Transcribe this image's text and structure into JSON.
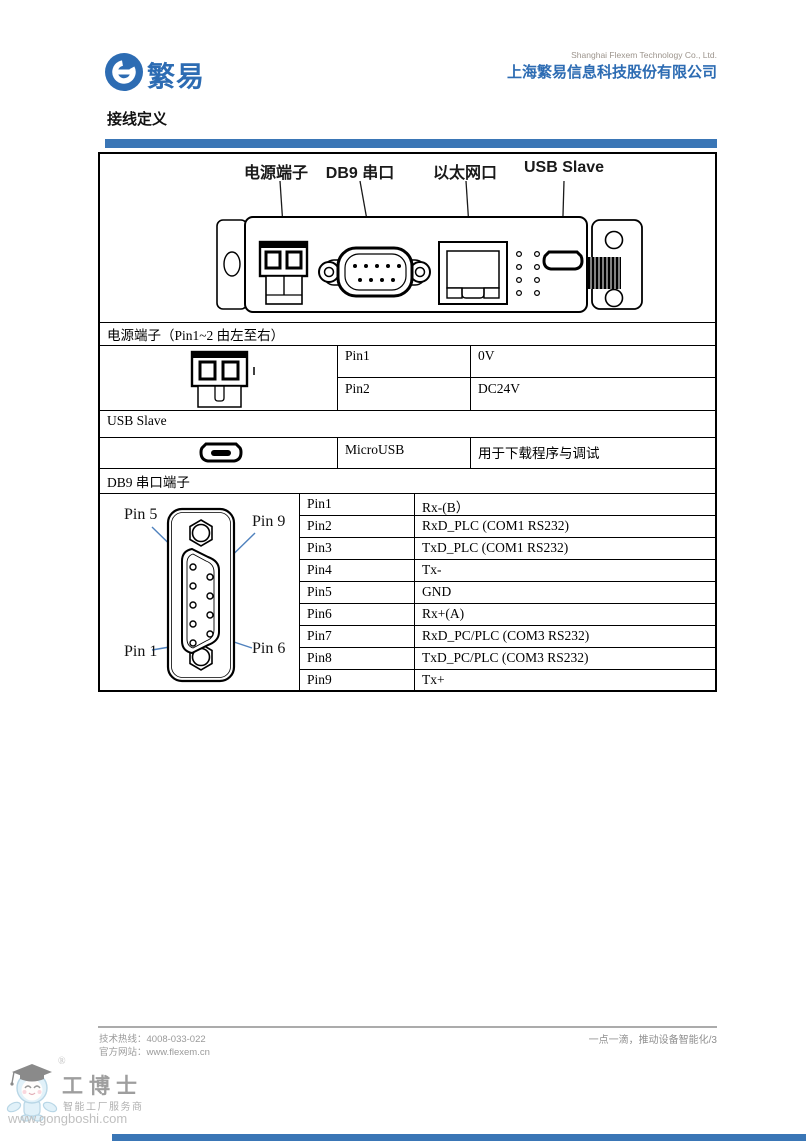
{
  "colors": {
    "brand_blue": "#2d6cb3",
    "bar_blue": "#3a76b6",
    "leader_blue": "#4f81bd"
  },
  "header": {
    "logo_text": "繁易",
    "company_en": "Shanghai Flexem Technology Co., Ltd.",
    "company_cn": "上海繁易信息科技股份有限公司"
  },
  "section_title": "接线定义",
  "device": {
    "labels": {
      "power": "电源端子",
      "db9": "DB9 串口",
      "ethernet": "以太网口",
      "usb": "USB Slave"
    }
  },
  "table": {
    "power": {
      "header": "电源端子（Pin1~2 由左至右）",
      "rows": [
        {
          "pin": "Pin1",
          "desc": "0V"
        },
        {
          "pin": "Pin2",
          "desc": "DC24V"
        }
      ]
    },
    "usb": {
      "header": "USB Slave",
      "rows": [
        {
          "pin": "MicroUSB",
          "desc": "用于下载程序与调试"
        }
      ]
    },
    "db9": {
      "header": "DB9 串口端子",
      "diagram_labels": {
        "top_left": "Pin 5",
        "top_right": "Pin 9",
        "bottom_left": "Pin 1",
        "bottom_right": "Pin 6"
      },
      "rows": [
        {
          "pin": "Pin1",
          "desc": "Rx-(B）"
        },
        {
          "pin": "Pin2",
          "desc": "RxD_PLC (COM1 RS232)"
        },
        {
          "pin": "Pin3",
          "desc": "TxD_PLC (COM1 RS232)"
        },
        {
          "pin": "Pin4",
          "desc": "Tx-"
        },
        {
          "pin": "Pin5",
          "desc": "GND"
        },
        {
          "pin": "Pin6",
          "desc": "Rx+(A)"
        },
        {
          "pin": "Pin7",
          "desc": "RxD_PC/PLC (COM3 RS232)"
        },
        {
          "pin": "Pin8",
          "desc": "TxD_PC/PLC (COM3 RS232)"
        },
        {
          "pin": "Pin9",
          "desc": "Tx+"
        }
      ]
    }
  },
  "footer": {
    "hotline": "技术热线：4008-033-022",
    "website": "官方网站：www.flexem.cn",
    "slogan": "一点一滴，推动设备智能化/3"
  },
  "watermark": {
    "registered": "®",
    "brand": "工博士",
    "tagline": "智能工厂服务商",
    "url": "www.gongboshi.com"
  }
}
